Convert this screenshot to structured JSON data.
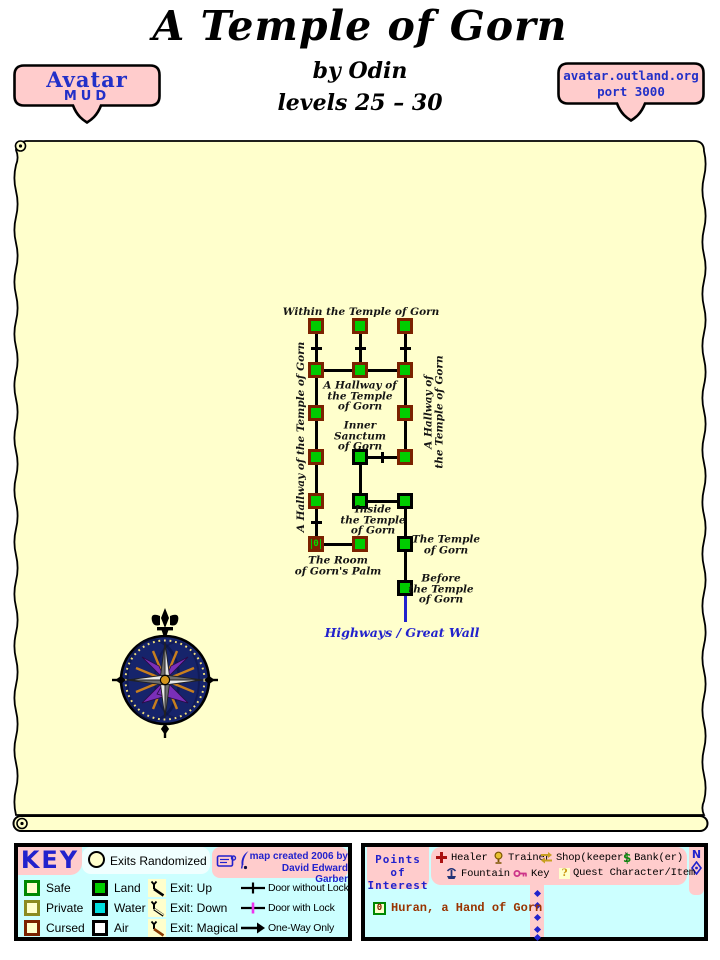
{
  "header": {
    "title": "A Temple of Gorn",
    "author": "by Odin",
    "levels": "levels 25 – 30"
  },
  "badge_left": {
    "line1": "Avatar",
    "line2": "MUD"
  },
  "badge_right": {
    "line1": "avatar.outland.org",
    "line2": "port 3000"
  },
  "colors": {
    "parchment": "#FFFFCC",
    "box_bg": "#CCFFFF",
    "pink": "#FFCCCC",
    "blue_text": "#2222CC",
    "room_green": "#00CC00",
    "cursed_border": "#7B2200",
    "water": "#00E0E0",
    "private_border": "#8B8B20",
    "safe_border": "#008800",
    "lock_magenta": "#EE33EE",
    "huran_text": "#993300"
  },
  "map": {
    "rooms": [
      {
        "x": 316,
        "y": 326,
        "cursed": true
      },
      {
        "x": 360,
        "y": 326,
        "cursed": true
      },
      {
        "x": 405,
        "y": 326,
        "cursed": true
      },
      {
        "x": 316,
        "y": 370,
        "cursed": true
      },
      {
        "x": 360,
        "y": 370,
        "cursed": true
      },
      {
        "x": 405,
        "y": 370,
        "cursed": true
      },
      {
        "x": 316,
        "y": 413,
        "cursed": true
      },
      {
        "x": 405,
        "y": 413,
        "cursed": true
      },
      {
        "x": 316,
        "y": 457,
        "cursed": true
      },
      {
        "x": 360,
        "y": 457,
        "cursed": false
      },
      {
        "x": 405,
        "y": 457,
        "cursed": true
      },
      {
        "x": 316,
        "y": 501,
        "cursed": true
      },
      {
        "x": 360,
        "y": 501,
        "cursed": false
      },
      {
        "x": 405,
        "y": 501,
        "cursed": false
      },
      {
        "x": 316,
        "y": 544,
        "cursed": true,
        "icon": "0"
      },
      {
        "x": 360,
        "y": 544,
        "cursed": true
      },
      {
        "x": 405,
        "y": 544,
        "cursed": false
      },
      {
        "x": 405,
        "y": 588,
        "cursed": false
      }
    ],
    "edges": [
      {
        "x1": 316,
        "y1": 326,
        "x2": 316,
        "y2": 370,
        "door": true
      },
      {
        "x1": 360,
        "y1": 326,
        "x2": 360,
        "y2": 370,
        "door": true
      },
      {
        "x1": 405,
        "y1": 326,
        "x2": 405,
        "y2": 370,
        "door": true
      },
      {
        "x1": 316,
        "y1": 370,
        "x2": 316,
        "y2": 413
      },
      {
        "x1": 316,
        "y1": 413,
        "x2": 316,
        "y2": 457
      },
      {
        "x1": 316,
        "y1": 457,
        "x2": 316,
        "y2": 501
      },
      {
        "x1": 316,
        "y1": 501,
        "x2": 316,
        "y2": 544,
        "door": true
      },
      {
        "x1": 405,
        "y1": 370,
        "x2": 405,
        "y2": 413
      },
      {
        "x1": 405,
        "y1": 413,
        "x2": 405,
        "y2": 457
      },
      {
        "x1": 360,
        "y1": 457,
        "x2": 360,
        "y2": 501
      },
      {
        "x1": 405,
        "y1": 501,
        "x2": 405,
        "y2": 544
      },
      {
        "x1": 405,
        "y1": 544,
        "x2": 405,
        "y2": 588
      },
      {
        "x1": 405,
        "y1": 588,
        "x2": 405,
        "y2": 622,
        "color": "blue"
      },
      {
        "x1": 316,
        "y1": 370,
        "x2": 360,
        "y2": 370
      },
      {
        "x1": 360,
        "y1": 370,
        "x2": 405,
        "y2": 370
      },
      {
        "x1": 360,
        "y1": 457,
        "x2": 405,
        "y2": 457,
        "door": true
      },
      {
        "x1": 360,
        "y1": 501,
        "x2": 405,
        "y2": 501
      },
      {
        "x1": 316,
        "y1": 544,
        "x2": 360,
        "y2": 544
      }
    ],
    "labels": [
      {
        "x": 361,
        "y": 312,
        "lines": [
          "Within the Temple of Gorn"
        ]
      },
      {
        "x": 360,
        "y": 396,
        "lines": [
          "A Hallway of",
          "the Temple",
          "of Gorn"
        ]
      },
      {
        "x": 360,
        "y": 436,
        "lines": [
          "Inner",
          "Sanctum",
          "of Gorn"
        ]
      },
      {
        "x": 301,
        "y": 437,
        "lines": [
          "A Hallway of the Temple of Gorn"
        ],
        "rotate": true
      },
      {
        "x": 434,
        "y": 412,
        "lines": [
          "A Hallway of",
          "the Temple of Gorn"
        ],
        "rotate": true
      },
      {
        "x": 373,
        "y": 520,
        "lines": [
          "Inside",
          "the Temple",
          "of Gorn"
        ]
      },
      {
        "x": 338,
        "y": 566,
        "lines": [
          "The Room",
          "of Gorn's Palm"
        ]
      },
      {
        "x": 446,
        "y": 545,
        "lines": [
          "The Temple",
          "of Gorn"
        ]
      },
      {
        "x": 441,
        "y": 589,
        "lines": [
          "Before",
          "the Temple",
          "of Gorn"
        ]
      },
      {
        "x": 402,
        "y": 633,
        "lines": [
          "Highways / Great Wall"
        ],
        "style": "highway"
      }
    ]
  },
  "key": {
    "title": "KEY",
    "exits_randomized": "Exits Randomized",
    "credit_line1": "map created 2006 by",
    "credit_line2": "David Edward Garber",
    "room_types": [
      {
        "label": "Safe",
        "fill": "#FFFFCC",
        "border": "#008800"
      },
      {
        "label": "Private",
        "fill": "#FFFFCC",
        "border": "#8B8B20"
      },
      {
        "label": "Cursed",
        "fill": "#FFFFCC",
        "border": "#7B2200"
      },
      {
        "label": "Land",
        "fill": "#00CC00",
        "border": "#000000"
      },
      {
        "label": "Water",
        "fill": "#00E0E0",
        "border": "#000000"
      },
      {
        "label": "Air",
        "fill": "#FFFFFF",
        "border": "#000000"
      }
    ],
    "exit_types": [
      {
        "label": "Exit: Up"
      },
      {
        "label": "Exit: Down"
      },
      {
        "label": "Exit: Magical"
      }
    ],
    "door_types": [
      {
        "label": "Door without Lock"
      },
      {
        "label": "Door with Lock"
      },
      {
        "label": "One-Way Only"
      }
    ]
  },
  "poi": {
    "title_line1": "Points of",
    "title_line2": "Interest",
    "north_label": "N",
    "legend": [
      {
        "label": "Healer"
      },
      {
        "label": "Trainer"
      },
      {
        "label": "Shop(keeper)"
      },
      {
        "label": "Bank(er)"
      },
      {
        "label": "Fountain"
      },
      {
        "label": "Key"
      },
      {
        "label": "Quest Character/Item"
      }
    ],
    "entries": [
      {
        "icon": "0",
        "label": "Huran, a Hand of Gorn"
      }
    ]
  }
}
